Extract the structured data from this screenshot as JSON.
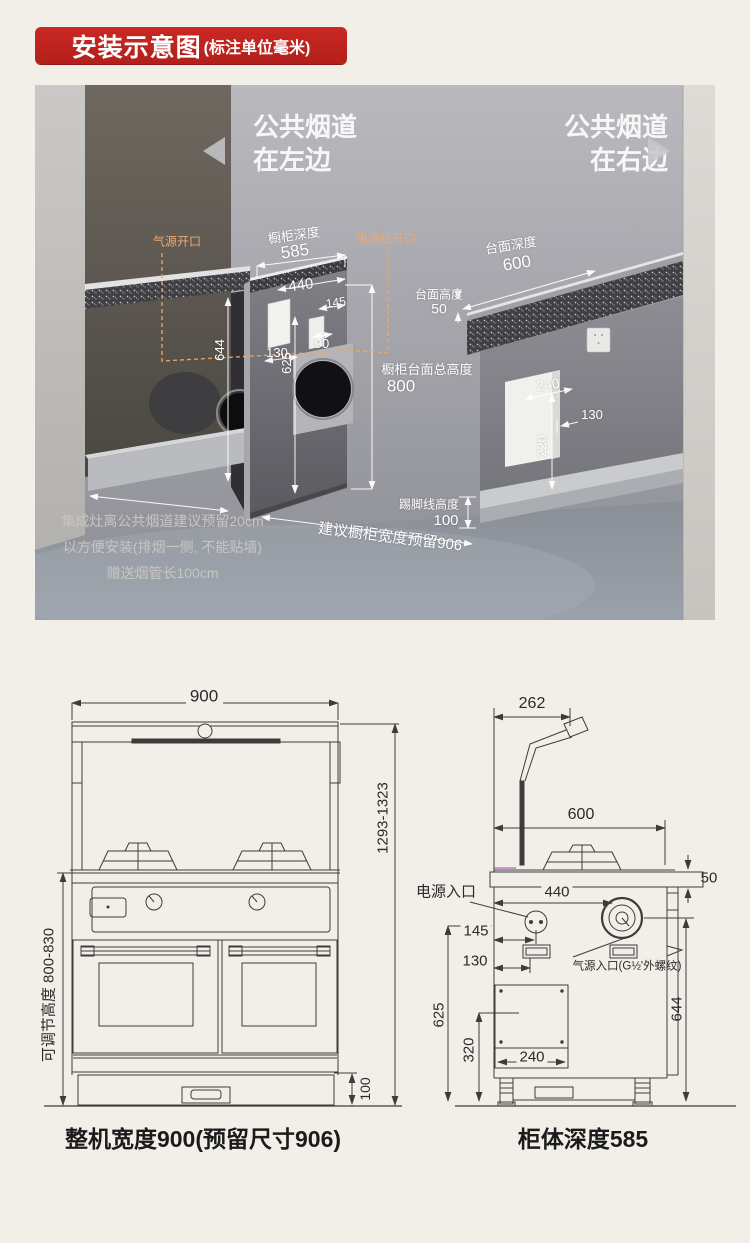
{
  "badge": {
    "title": "安装示意图",
    "unit": "(标注单位毫米)"
  },
  "colors": {
    "accent_red": "#c0241f",
    "accent_orange": "#ecaa72",
    "dim_line": "#ffffff",
    "drawing_line": "#3c3c3c"
  },
  "scene": {
    "flue_left1": "公共烟道",
    "flue_left2": "在左边",
    "flue_right1": "公共烟道",
    "flue_right2": "在右边",
    "gas_open": "气源开口",
    "power_open": "电源线开口",
    "cab_depth_l": "橱柜深度",
    "cab_depth_v": "585",
    "d440": "440",
    "d145": "145",
    "d130": "130",
    "d90": "90",
    "d644": "644",
    "d625": "625",
    "total_h_l": "橱柜台面总高度",
    "total_h_v": "800",
    "top_depth_l": "台面深度",
    "top_depth_v": "600",
    "top_h_l": "台面高度",
    "top_h_v": "50",
    "d240": "240",
    "d130r": "130",
    "d220": "220",
    "skirt_l": "踢脚线高度",
    "skirt_v": "100",
    "suggest": "建议橱柜宽度预留906",
    "note1": "集成灶离公共烟道建议预留20cm",
    "note2": "以方便安装(排烟一侧, 不能贴墙)",
    "note3": "赠送烟管长100cm"
  },
  "front_view": {
    "w900": "900",
    "h_range": "1293-1323",
    "adjust": "可调节高度  800-830",
    "d100": "100",
    "caption": "整机宽度900(预留尺寸906)"
  },
  "side_view": {
    "d262": "262",
    "d600": "600",
    "d50": "50",
    "power_label": "电源入口",
    "d440": "440",
    "d145": "145",
    "d130": "130",
    "gas_label": "气源入口(G½'外螺纹)",
    "d625": "625",
    "d320": "320",
    "d240": "240",
    "d644": "644",
    "caption": "柜体深度585"
  }
}
